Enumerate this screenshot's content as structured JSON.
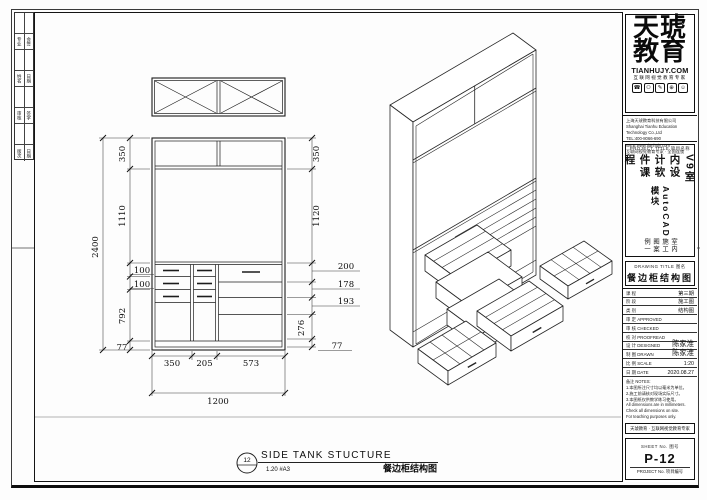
{
  "frame": {
    "strip": [
      [
        "专业",
        "会签"
      ],
      [
        "姓名",
        "日期"
      ],
      [
        "审核",
        "签字"
      ],
      [
        "版次",
        "日期"
      ]
    ]
  },
  "brand": {
    "logo_top": "天琥",
    "logo_bottom": "教育",
    "site": "TIANHUJY.COM",
    "tagline": "互联网视觉教育专家",
    "icons": [
      "☎",
      "⚇",
      "✎",
      "⊕",
      "☺"
    ],
    "company": [
      "上海天琥教育科技有限公司",
      "Shanghai Tianhu Education Technology Co.,Ltd",
      "TEL:400-8066-690  WEB:www.tianhujy.com",
      "互联网视觉教育专家 · 全国连锁"
    ]
  },
  "titleblock": {
    "project_header": "PROJECT TITLE  项目名称",
    "project_lines": [
      "V9室内设计软件课程",
      "AutoCAD模块",
      "室内施工图案例一"
    ],
    "drawing_header": "DRAWING TITLE  图名",
    "drawing_title": "餐边柜结构图",
    "rows": [
      {
        "label": "课 程",
        "value": "第三期"
      },
      {
        "label": "阶 段",
        "value": "施工图"
      },
      {
        "label": "类 别",
        "value": "结构图"
      },
      {
        "label": "审 定 APPROVED",
        "value": ""
      },
      {
        "label": "审 核 CHECKED",
        "value": ""
      },
      {
        "label": "校 对 PROOFREAD",
        "value": ""
      },
      {
        "label": "设 计 DESIGNED",
        "value": "陈家淮"
      },
      {
        "label": "制 图 DRAWN",
        "value": "陈家淮"
      },
      {
        "label": "比 例 SCALE",
        "value": "1:20"
      },
      {
        "label": "日 期 DATE",
        "value": "2020.08.27"
      }
    ],
    "notes": [
      "备注 NOTES:",
      "1.本图所注尺寸均以毫米为单位。",
      "2.施工前请核对现场实际尺寸。",
      "3.本图纸仅供教学练习使用。",
      "All dimensions are in millimeters.",
      "Check all dimensions on site.",
      "For teaching purposes only."
    ],
    "stamp_note": "天琥教育 · 互联网视觉教育专家",
    "sheet_no_label": "SHEET No.  图号",
    "sheet_no": "P-12",
    "project_no_label": "PROJECT No.  项目编号"
  },
  "drawing": {
    "detail_number": "12",
    "title_en": "SIDE TANK STUCTURE",
    "scale_note": "1.20 #A3",
    "title_cn": "餐边柜结构图",
    "dims": {
      "height_total": "2400",
      "h1": "350",
      "h2": "1110",
      "h3": "100",
      "h4": "100",
      "h5": "792",
      "h6": "77",
      "r1": "350",
      "r2": "1120",
      "r3": "200",
      "r4": "178",
      "r5": "193",
      "r6": "276",
      "r7": "77",
      "w1": "350",
      "w2": "205",
      "w3": "573",
      "width_total": "1200"
    }
  }
}
